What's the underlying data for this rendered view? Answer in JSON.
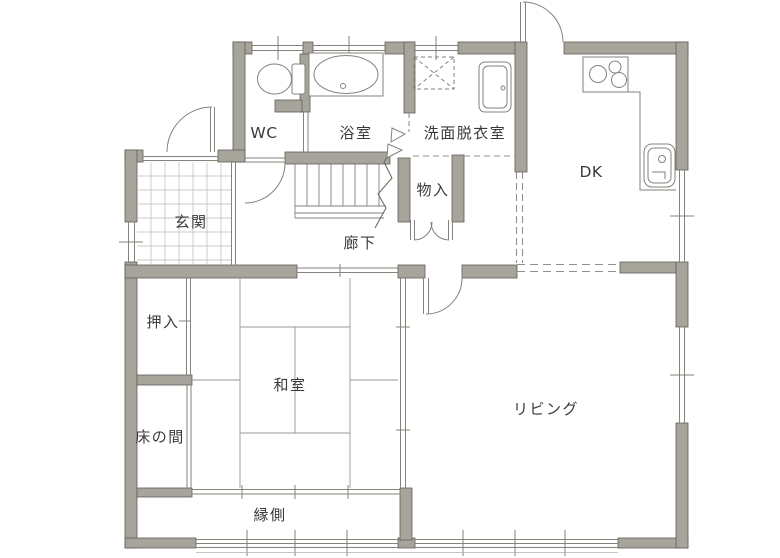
{
  "floorplan": {
    "title": "1F floor plan",
    "rooms": [
      {
        "id": "wc",
        "label": "WC"
      },
      {
        "id": "bathroom",
        "label": "浴室"
      },
      {
        "id": "washroom",
        "label": "洗面脱衣室"
      },
      {
        "id": "dining-kitchen",
        "label": "DK"
      },
      {
        "id": "entrance",
        "label": "玄関"
      },
      {
        "id": "storage",
        "label": "物入"
      },
      {
        "id": "hallway",
        "label": "廊下"
      },
      {
        "id": "closet",
        "label": "押入"
      },
      {
        "id": "tatami-room",
        "label": "和室"
      },
      {
        "id": "living",
        "label": "リビング"
      },
      {
        "id": "tokonoma",
        "label": "床の間"
      },
      {
        "id": "veranda",
        "label": "縁側"
      }
    ],
    "fixtures": [
      "toilet",
      "bathtub",
      "washing-machine-pan",
      "washbasin",
      "gas-stove",
      "kitchen-counter",
      "kitchen-sink",
      "staircase"
    ],
    "colors": {
      "wall_fill": "#a7a49c",
      "wall_stroke": "#615d56",
      "line": "#85827a",
      "tile_line": "#bdbab2",
      "text": "#3a3a3a",
      "background": "#ffffff"
    }
  }
}
